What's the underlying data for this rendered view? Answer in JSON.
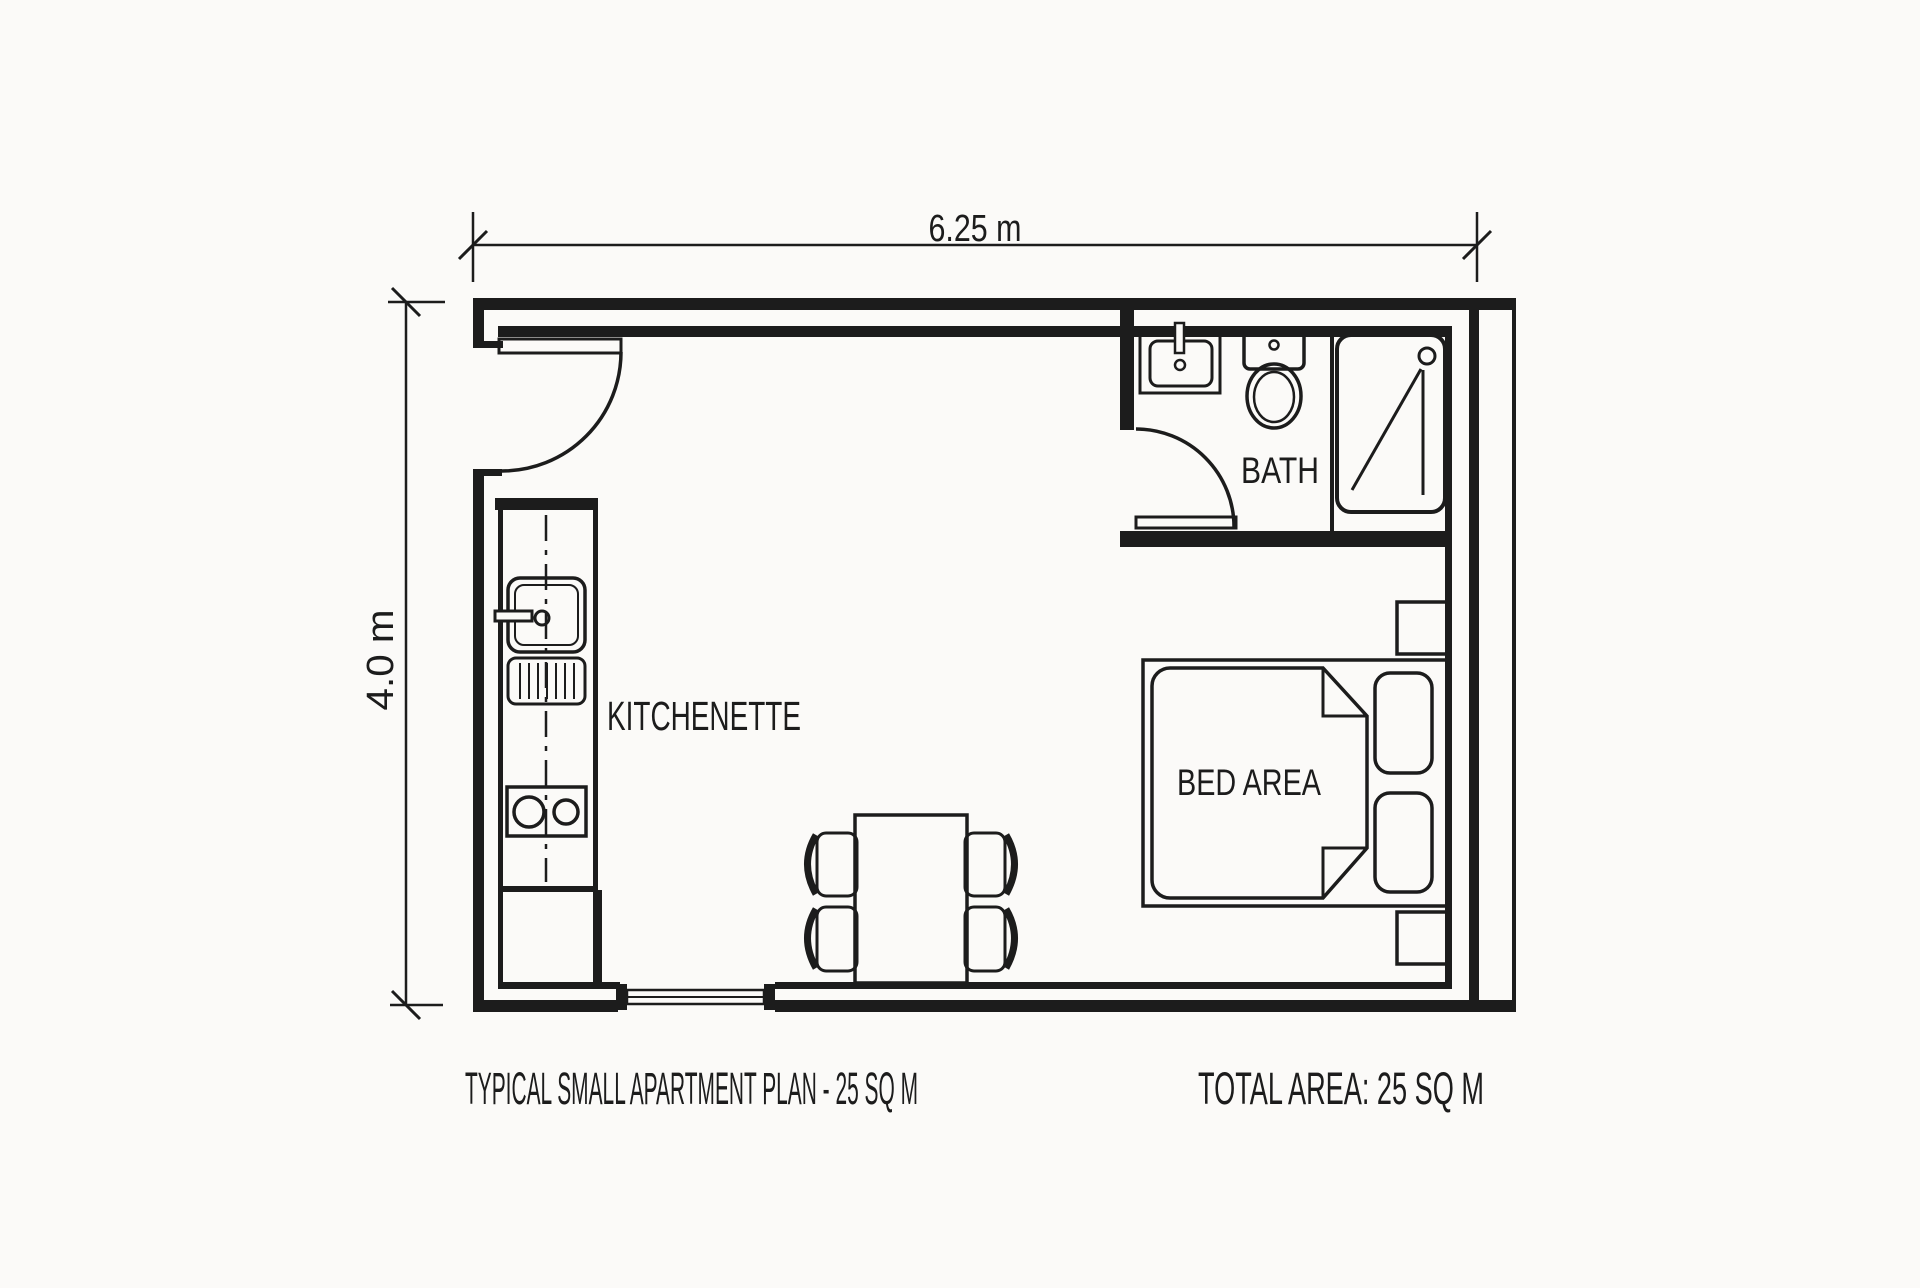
{
  "drawing": {
    "type": "architectural floor plan",
    "background_color": "#fbfaf8",
    "line_color": "#1c1c1c"
  },
  "dimensions": {
    "width_label": "6.25 m",
    "height_label": "4.0 m"
  },
  "rooms": {
    "kitchenette": "KITCHENETTE",
    "bath": "BATH",
    "bed_area": "BED AREA"
  },
  "footer": {
    "title": "TYPICAL SMALL APARTMENT PLAN - 25 SQ M",
    "total_area": "TOTAL AREA: 25 SQ M"
  },
  "fixtures": [
    "entry-door-swing",
    "bath-door-swing",
    "bathroom-vanity-sink",
    "toilet",
    "shower-stall",
    "kitchen-sink-with-drainboard",
    "two-burner-stove",
    "kitchen-counter",
    "dining-table",
    "four-chairs",
    "window",
    "double-bed-with-duvet",
    "two-pillows",
    "two-nightstands"
  ]
}
